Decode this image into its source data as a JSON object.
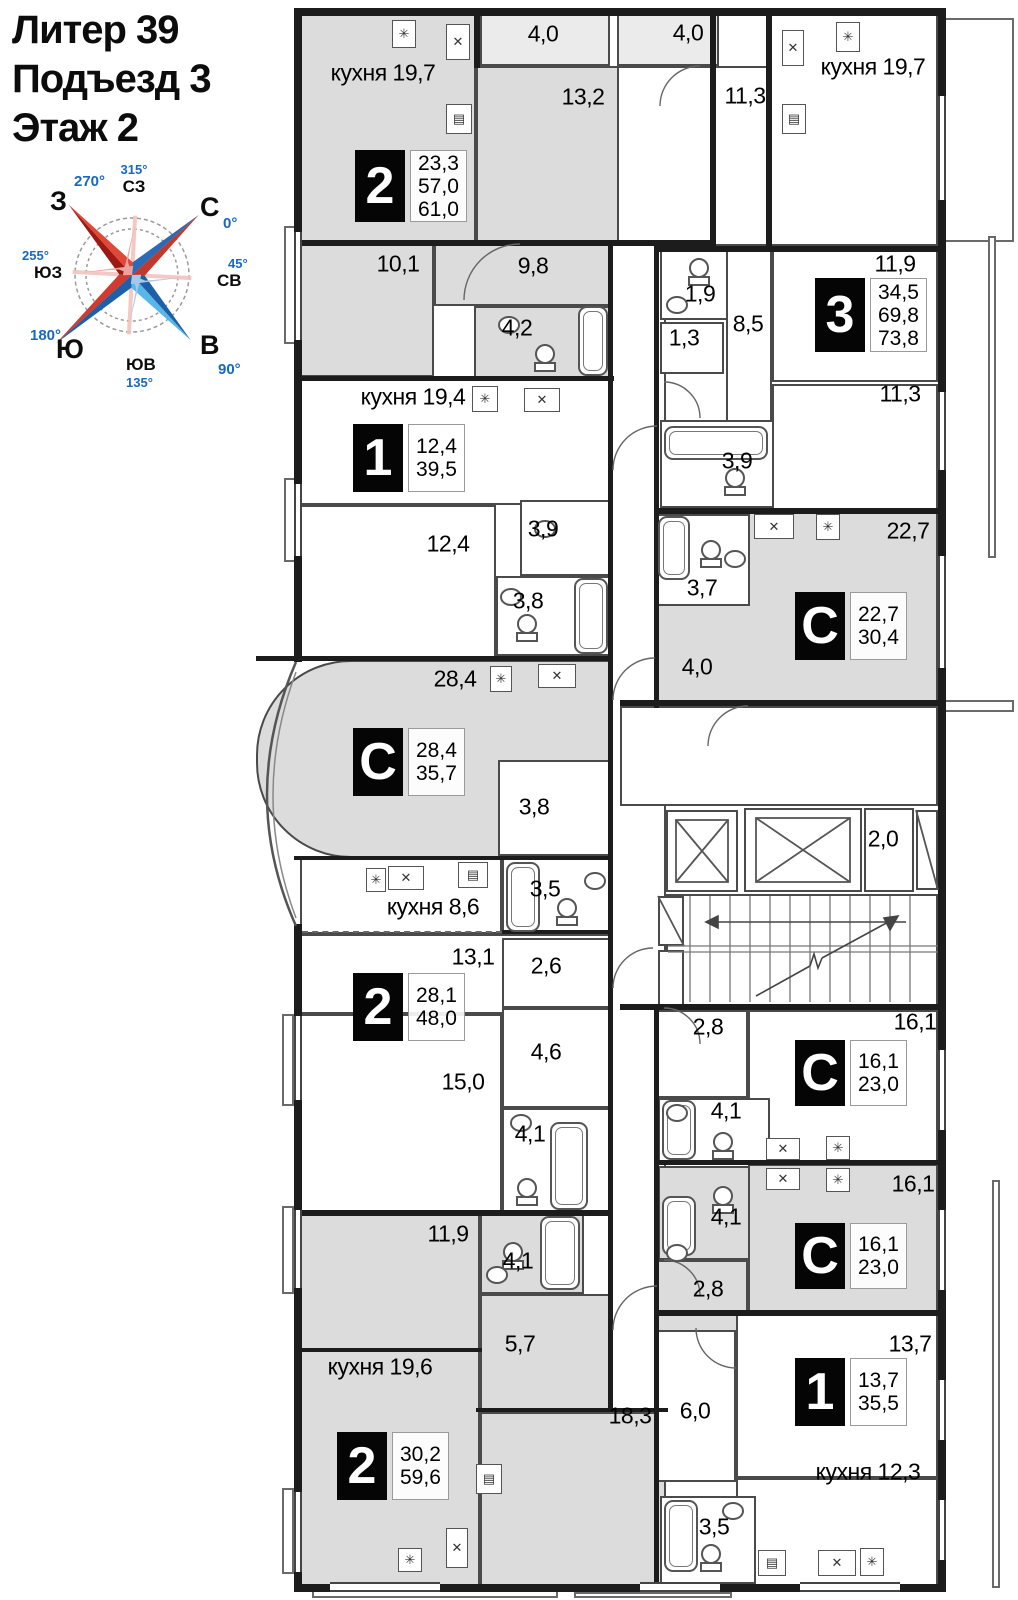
{
  "header": {
    "line1": "Литер 39",
    "line2": "Подъезд 3",
    "line3": "Этаж 2"
  },
  "compass": {
    "north": "С",
    "east": "В",
    "south": "Ю",
    "west": "З",
    "ne": "СВ",
    "nw": "СЗ",
    "se": "ЮВ",
    "sw": "ЮЗ",
    "deg_n": "0°",
    "deg_e": "90°",
    "deg_s": "180°",
    "deg_w": "270°",
    "deg_ne": "45°",
    "deg_nw": "315°",
    "deg_se": "135°",
    "deg_sw": "255°"
  },
  "icons": {
    "boiler": "✳",
    "sink": "✕",
    "stove": "▤"
  },
  "rooms": [
    "4,0",
    "13,2",
    "кухня 19,7",
    "4,0",
    "11,3",
    "кухня 19,7",
    "10,1",
    "9,8",
    "4,2",
    "1,9",
    "8,5",
    "1,3",
    "11,9",
    "кухня 19,4",
    "3,9",
    "11,3",
    "12,4",
    "3,9",
    "3,8",
    "22,7",
    "3,7",
    "28,4",
    "4,0",
    "3,8",
    "3,5",
    "кухня 8,6",
    "2,0",
    "13,1",
    "2,6",
    "2,8",
    "16,1",
    "4,6",
    "15,0",
    "4,1",
    "4,1",
    "16,1",
    "11,9",
    "4,1",
    "4,1",
    "2,8",
    "5,7",
    "кухня 19,6",
    "18,3",
    "13,7",
    "6,0",
    "кухня 12,3",
    "3,5"
  ],
  "apartments": [
    {
      "badge": "2",
      "values": [
        "23,3",
        "57,0",
        "61,0"
      ]
    },
    {
      "badge": "1",
      "values": [
        "12,4",
        "39,5"
      ]
    },
    {
      "badge": "С",
      "values": [
        "28,4",
        "35,7"
      ]
    },
    {
      "badge": "2",
      "values": [
        "28,1",
        "48,0"
      ]
    },
    {
      "badge": "2",
      "values": [
        "30,2",
        "59,6"
      ]
    },
    {
      "badge": "3",
      "values": [
        "34,5",
        "69,8",
        "73,8"
      ]
    },
    {
      "badge": "С",
      "values": [
        "22,7",
        "30,4"
      ]
    },
    {
      "badge": "С",
      "values": [
        "16,1",
        "23,0"
      ]
    },
    {
      "badge": "С",
      "values": [
        "16,1",
        "23,0"
      ]
    },
    {
      "badge": "1",
      "values": [
        "13,7",
        "35,5"
      ]
    }
  ]
}
